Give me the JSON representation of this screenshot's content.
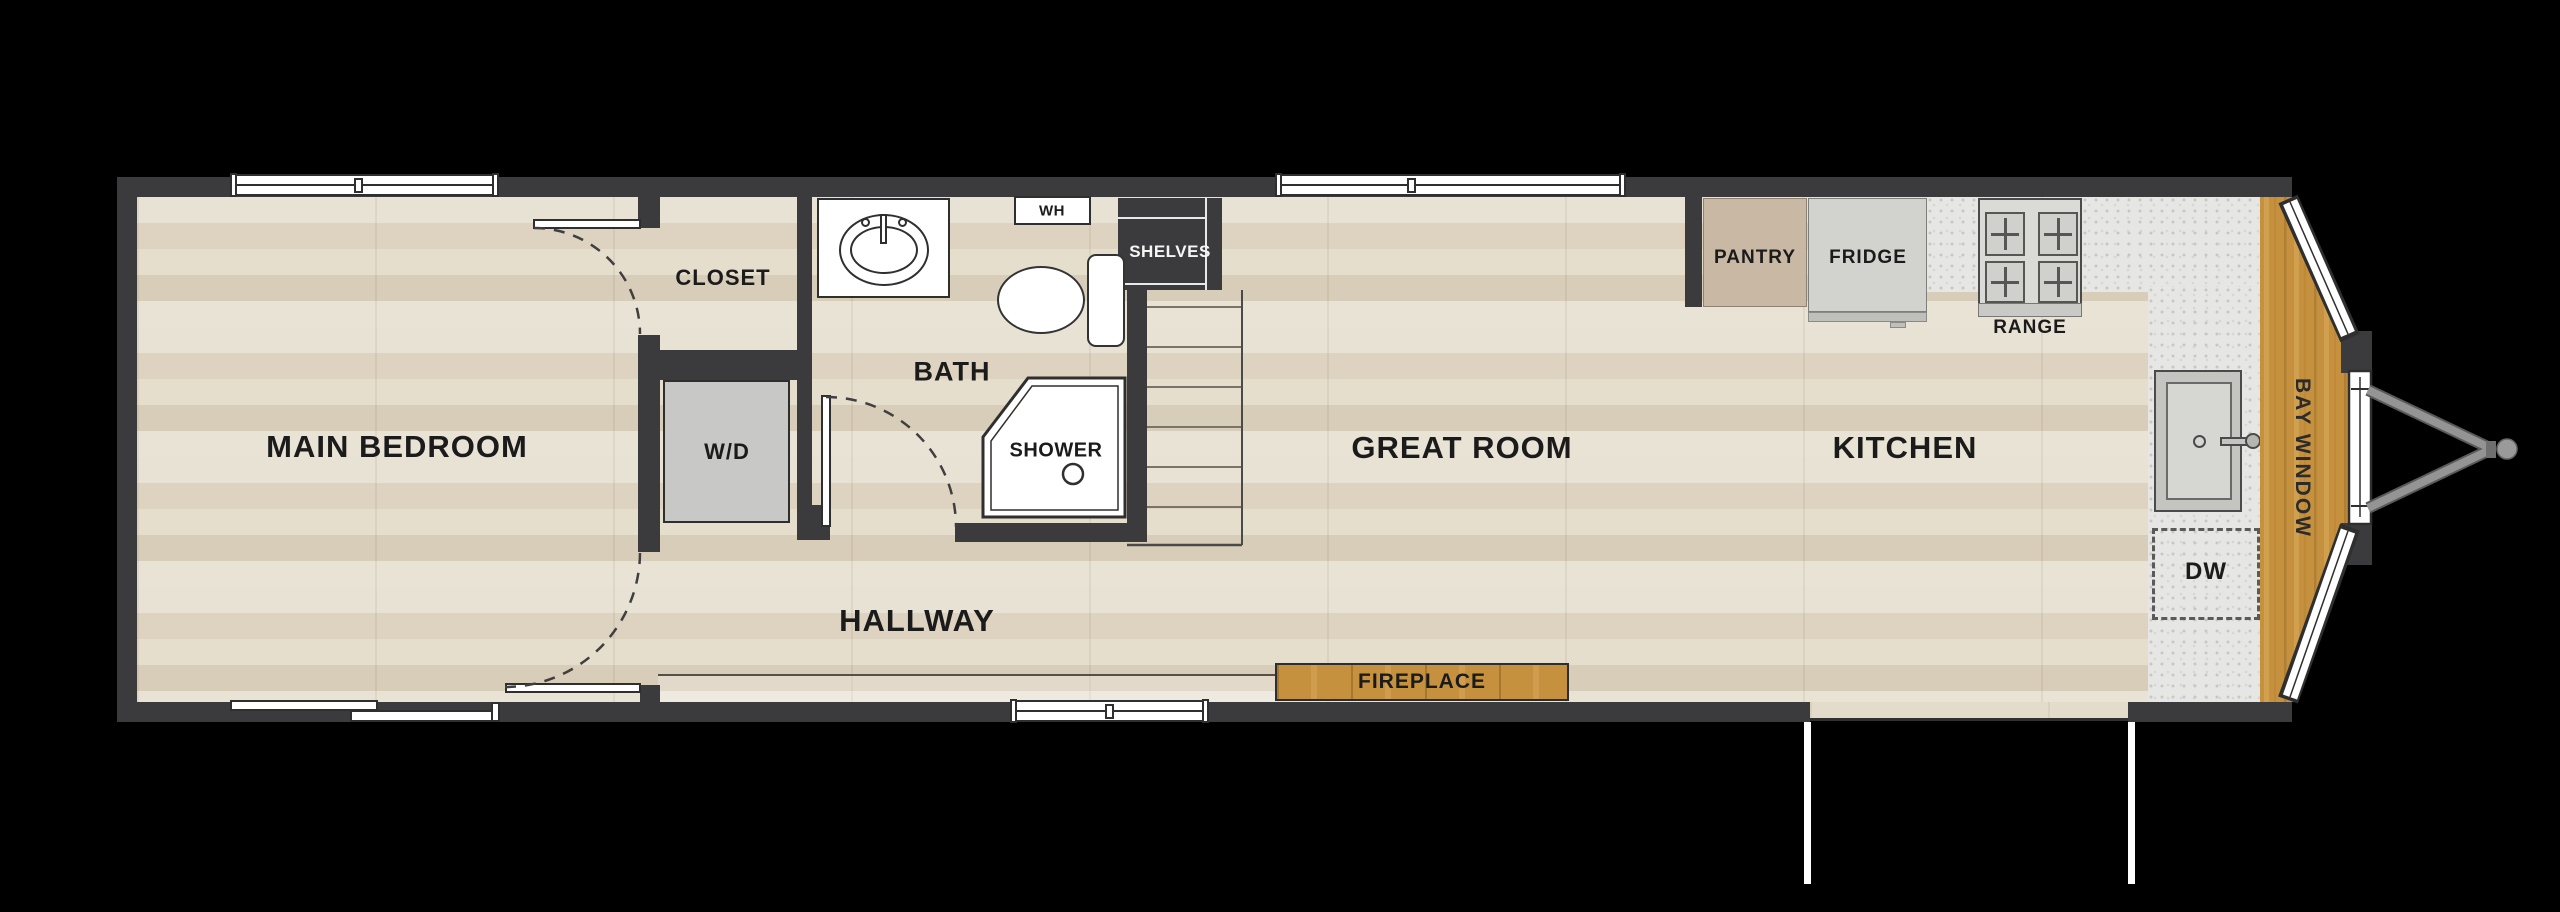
{
  "floorplan": {
    "rooms": {
      "main_bedroom": "MAIN BEDROOM",
      "closet": "CLOSET",
      "bath": "BATH",
      "hallway": "HALLWAY",
      "great_room": "GREAT ROOM",
      "kitchen": "KITCHEN"
    },
    "fixtures": {
      "washer_dryer": "W/D",
      "water_heater": "WH",
      "shelves": "SHELVES",
      "shower": "SHOWER",
      "fireplace": "FIREPLACE",
      "pantry": "PANTRY",
      "fridge": "FRIDGE",
      "range": "RANGE",
      "dishwasher": "DW",
      "bay_window": "BAY WINDOW"
    },
    "colors": {
      "background": "#000000",
      "wall": "#3b3b3d",
      "floor_wood": "#e2dac9",
      "accent_wood": "#c5913e",
      "counter": "#e6e6e4",
      "appliance_gray": "#d2d2cf",
      "pantry_tan": "#c9b9a4",
      "label_text": "#1b1b1b"
    }
  }
}
